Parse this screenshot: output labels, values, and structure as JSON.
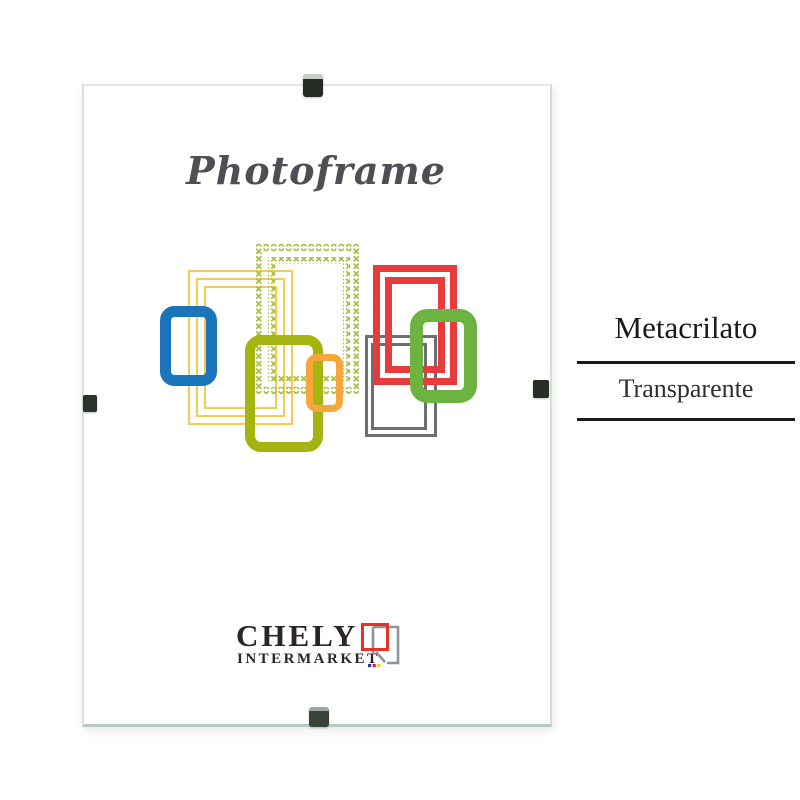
{
  "product_card": {
    "script_title": "Photoframe",
    "brand": {
      "name": "CHELY",
      "subtitle": "INTERMARKET"
    },
    "specs": {
      "material": "Metacrilato",
      "finish": "Transparente"
    }
  },
  "artwork_colors": {
    "yellow": "#F1CE53",
    "stitch": "#A9BA3F",
    "blue": "#1B75BB",
    "olive": "#A4B511",
    "orange": "#F5A73B",
    "gray": "#6D6E71",
    "red": "#E73B3E",
    "green": "#6CB33F"
  },
  "logo_colors": {
    "square_red": "#E6332A",
    "frame_gray": "#8E959A",
    "dot_blue": "#2B3990",
    "dot_red": "#ED1C24",
    "dot_yellow": "#FFCB05"
  },
  "text_colors": {
    "script": "#4E4E55",
    "brand": "#2B2526",
    "spec_primary": "#1A1A1A",
    "spec_secondary": "#2F2F2F",
    "rule": "#1B1B1B"
  }
}
